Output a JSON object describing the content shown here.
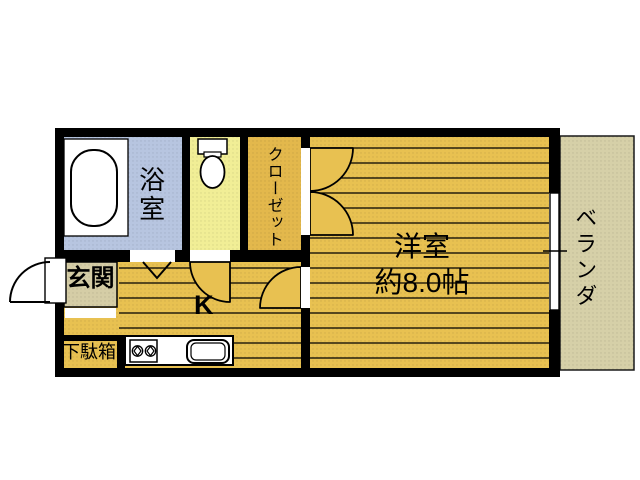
{
  "floorplan": {
    "rooms": {
      "bathroom": {
        "label": "浴室"
      },
      "closet": {
        "label": "クローゼット"
      },
      "western_room": {
        "name": "洋室",
        "size": "約8.0帖"
      },
      "veranda": {
        "label": "ベランダ"
      },
      "entrance": {
        "label": "玄関"
      },
      "kitchen": {
        "label": "K"
      },
      "shoe_cabinet": {
        "label": "下駄箱"
      }
    },
    "fixtures": {
      "bathtub": "bathtub-icon",
      "toilet": "toilet-icon",
      "stove": "stove-icon",
      "sink": "sink-icon",
      "window": "sliding-window-icon",
      "doors": "door-swing-arc-icons"
    },
    "colors": {
      "wall": "#000000",
      "wood_floor": "#e8c151",
      "closet_floor": "#e3b84c",
      "bathroom_floor": "#b7c5e0",
      "toilet_floor": "#f1ee96",
      "entrance_floor": "#d5cda6",
      "veranda_floor": "#d6d0a8",
      "fixture_white": "#ffffff"
    }
  }
}
